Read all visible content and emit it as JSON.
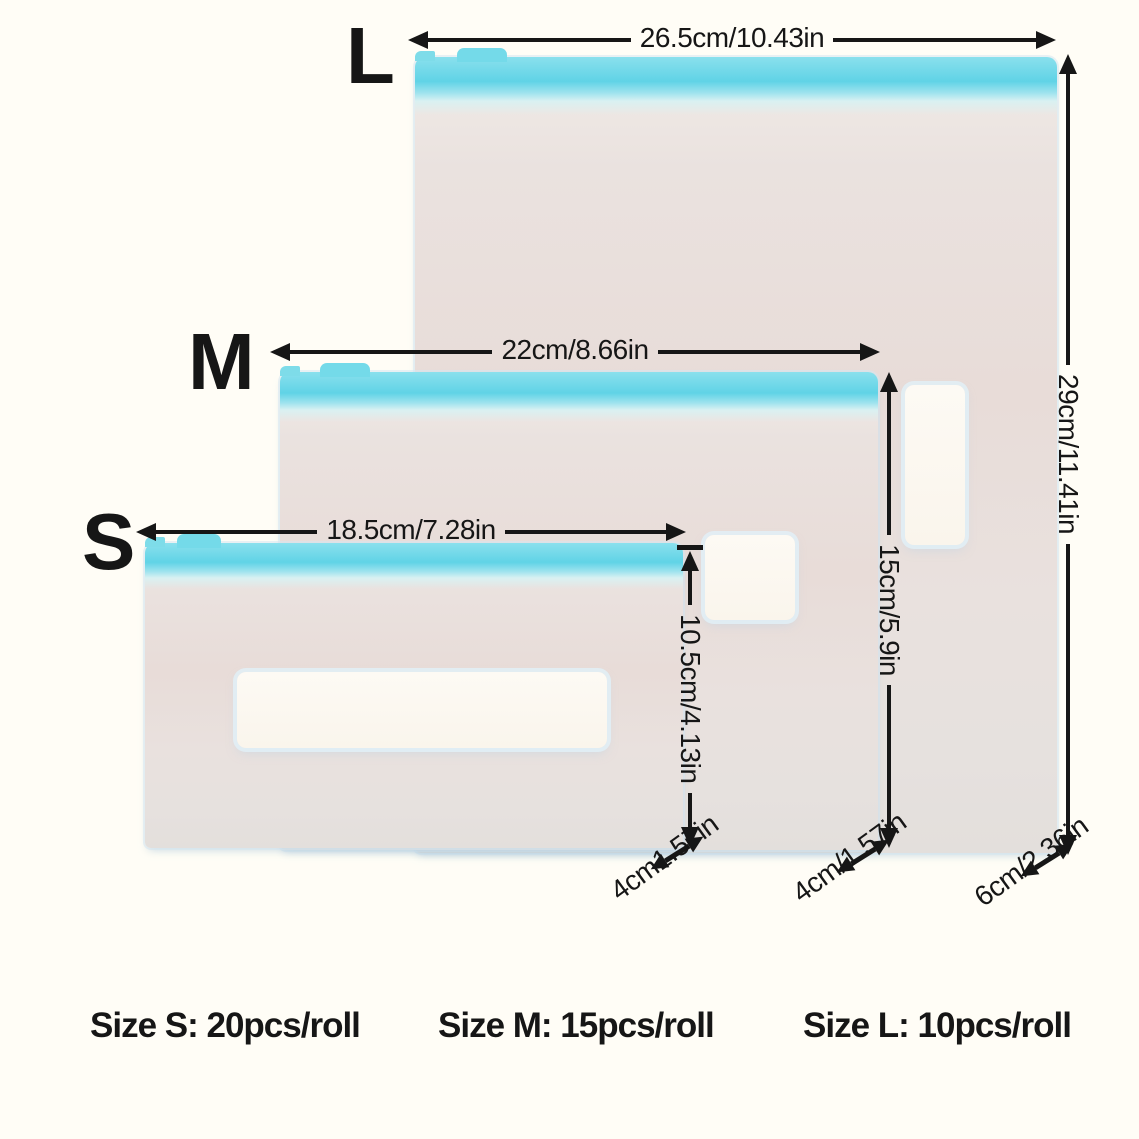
{
  "colors": {
    "background": "#fffdf6",
    "ink": "#161616",
    "zipper_cyan": "#60d3e6",
    "bag_body": "#e8dedb",
    "label_patch": "#fcf8f0"
  },
  "bags": [
    {
      "letter": "L",
      "width_label": "26.5cm/10.43in",
      "height_label": "29cm/11.41in",
      "gusset_label": "6cm/2.36in"
    },
    {
      "letter": "M",
      "width_label": "22cm/8.66in",
      "height_label": "15cm/5.9in",
      "gusset_label": "4cm/1.57in"
    },
    {
      "letter": "S",
      "width_label": "18.5cm/7.28in",
      "height_label": "10.5cm/4.13in",
      "gusset_label": "4cm1.57in"
    }
  ],
  "footer": [
    {
      "label": "Size S: 20pcs/roll"
    },
    {
      "label": "Size M: 15pcs/roll"
    },
    {
      "label": "Size L: 10pcs/roll"
    }
  ]
}
